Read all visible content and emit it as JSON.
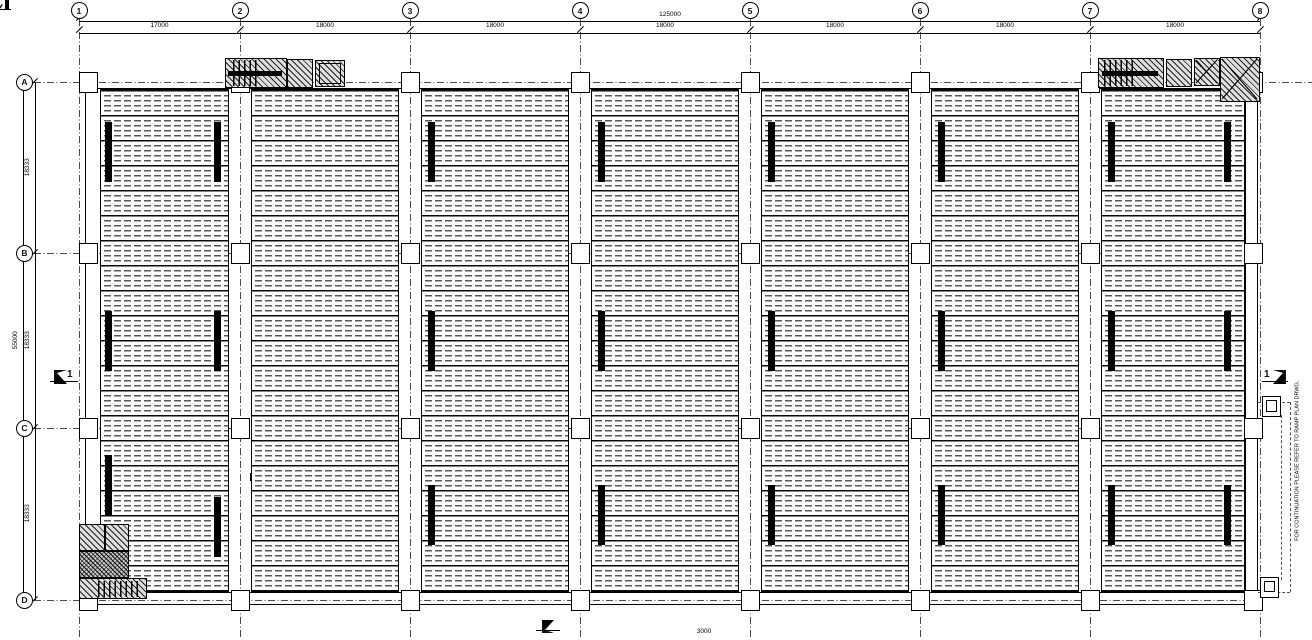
{
  "grid": {
    "columns": [
      "1",
      "2",
      "3",
      "4",
      "5",
      "6",
      "7",
      "8"
    ],
    "rows": [
      "A",
      "B",
      "C",
      "D"
    ]
  },
  "dimensions": {
    "top_overall": "125000",
    "top_bays": [
      "17000",
      "18000",
      "18000",
      "18000",
      "18000",
      "18000",
      "18000"
    ],
    "left_overall": "55000",
    "left_rows": [
      "18333",
      "18333",
      "18333"
    ],
    "bottom_ramp": "3000"
  },
  "labels": {
    "opening_beam_1": "RCB1 500/625 x 1500",
    "opening_beam_2": "RCB2 500/625 x 1500",
    "ramp_note": "FOR CONTINUATION PLEASE REFER TO RAMP PLAN DRWG.",
    "section_left": "1",
    "section_right": "1"
  },
  "colors": {
    "ink": "#111111",
    "hatch_fill": "#dedede",
    "plank_line": "#585858"
  }
}
